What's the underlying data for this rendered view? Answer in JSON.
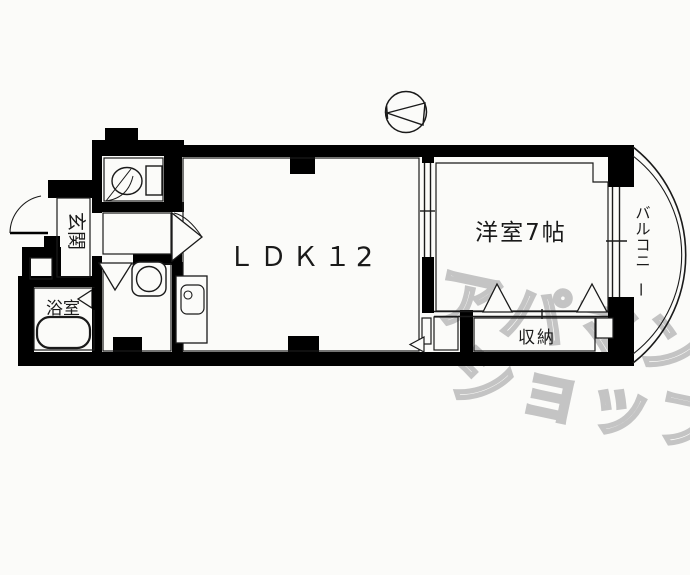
{
  "page": {
    "type": "real-estate-floor-plan",
    "background": "#fbfbf9"
  },
  "floor_plan": {
    "labels": {
      "ldk": "ＬＤＫ１2",
      "bedroom": "洋室7帖",
      "balcony": "バルコニー",
      "closet": "収納",
      "entrance": "玄関",
      "bath": "浴室"
    },
    "watermark": {
      "line1": "アパマン",
      "line2": "ショップ",
      "color": "#c4c4c4"
    },
    "colors": {
      "walls": "#000000",
      "background": "#fbfbf9",
      "thin_lines": "#1a1a1a"
    },
    "symbols": [
      "north-arrow-compass",
      "toilet",
      "bathtub",
      "wash-basin",
      "kitchen-sink",
      "entrance-door-swing",
      "sliding-partition-door",
      "folding-closet-doors",
      "balcony-arc"
    ]
  }
}
